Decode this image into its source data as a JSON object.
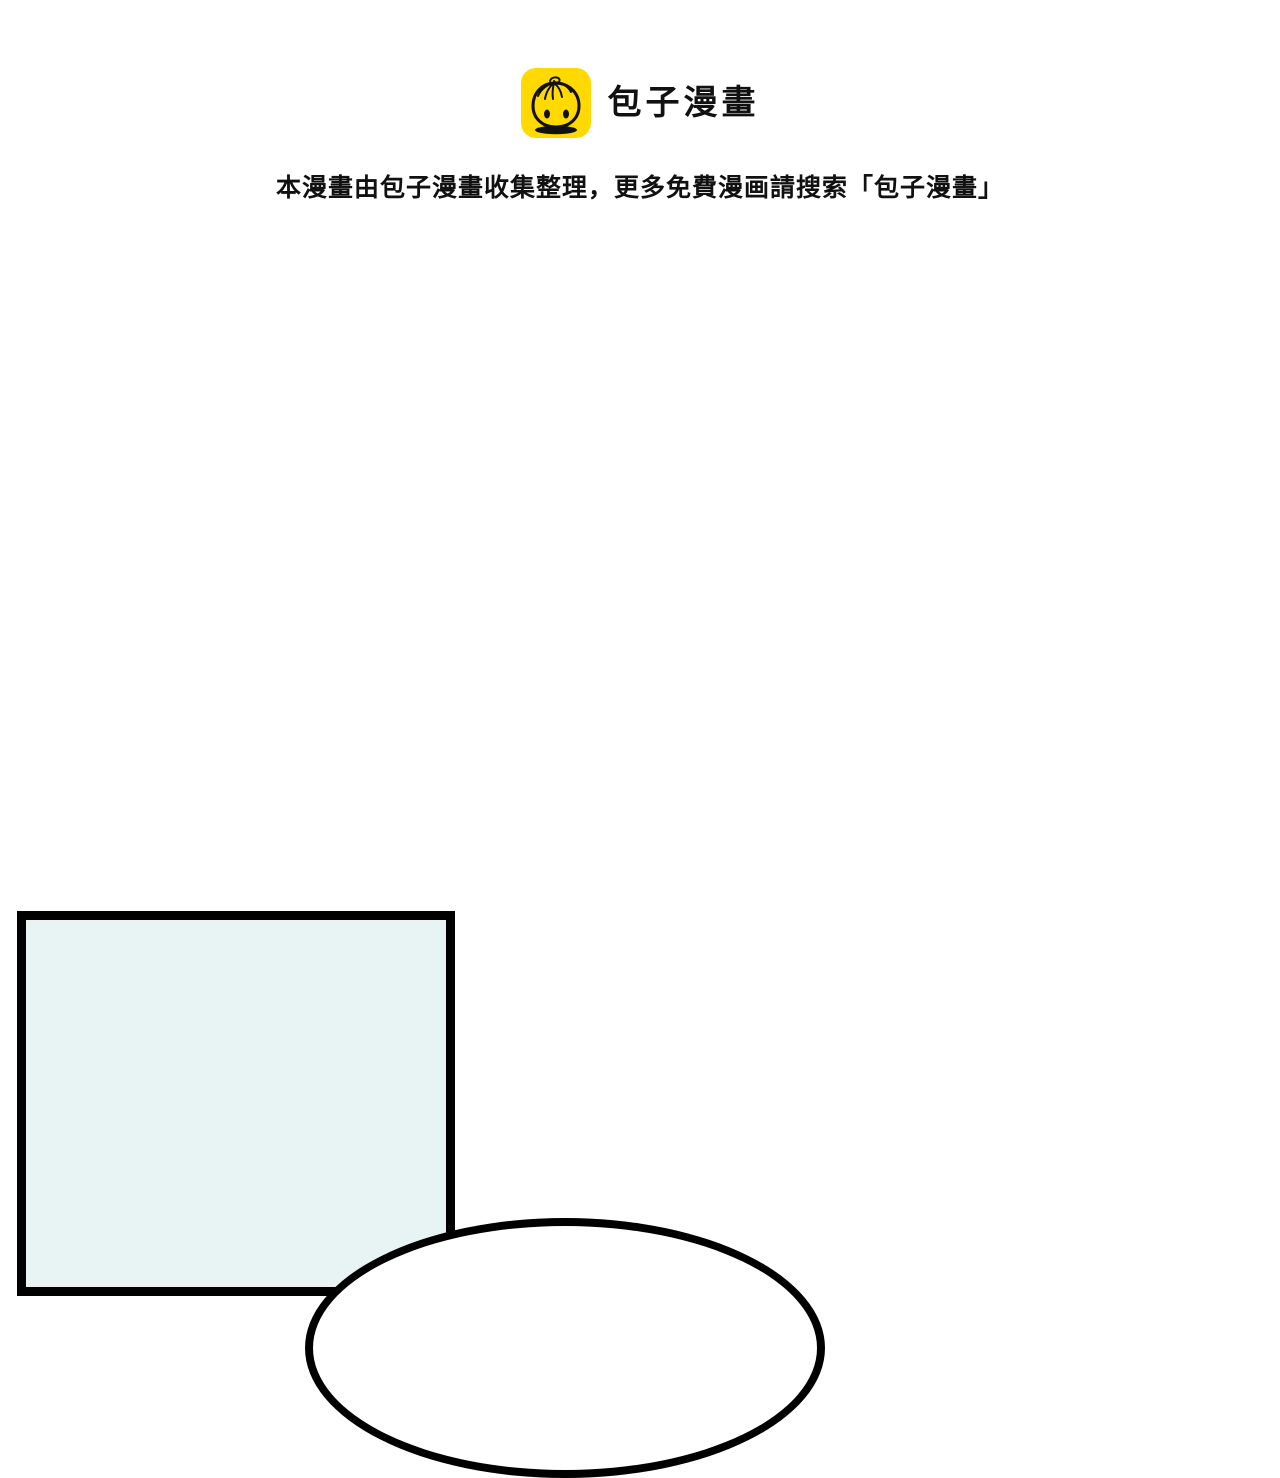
{
  "header": {
    "brand_name": "包子漫畫",
    "tagline": "本漫畫由包子漫畫收集整理，更多免費漫画請搜索「包子漫畫」"
  },
  "icons": {
    "logo": "baozi-bun-icon"
  },
  "comic": {
    "panel_content": "",
    "speech_bubble_content": ""
  },
  "theme": {
    "brand_yellow": "#FFD900",
    "ink": "#111111",
    "page_bg": "#FFFFFF",
    "panel_fill": "#E8F3F3",
    "panel_border": "#000000",
    "bubble_fill": "#FFFFFF",
    "bubble_border": "#000000"
  }
}
